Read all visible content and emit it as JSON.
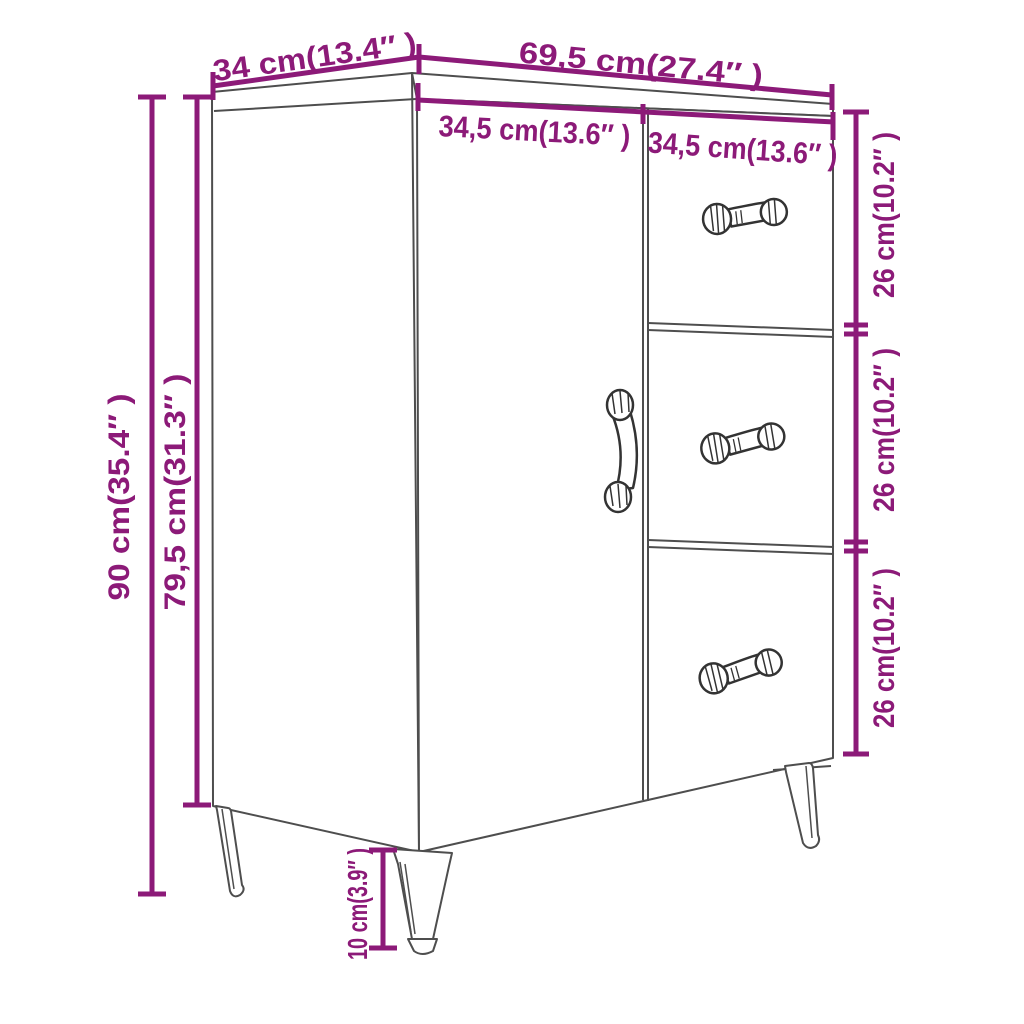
{
  "diagram": {
    "subject": "sideboard with door, three drawers and four legs",
    "colors": {
      "dimension_accent": "#8c1a78",
      "furniture_outline": "#4e4e4e",
      "handle_outline": "#333333",
      "background": "#ffffff"
    },
    "dimensions": {
      "top_depth": "34 cm(13.4″ )",
      "top_width": "69,5 cm(27.4″ )",
      "door_width": "34,5 cm(13.6″ )",
      "drawers_width": "34,5 cm(13.6″ )",
      "drawer_top_height": "26 cm(10.2″ )",
      "drawer_middle_height": "26 cm(10.2″ )",
      "drawer_bottom_height": "26 cm(10.2″ )",
      "overall_height": "90 cm(35.4″ )",
      "body_height": "79,5 cm(31.3″ )",
      "leg_height": "10 cm(3.9″ )"
    }
  }
}
